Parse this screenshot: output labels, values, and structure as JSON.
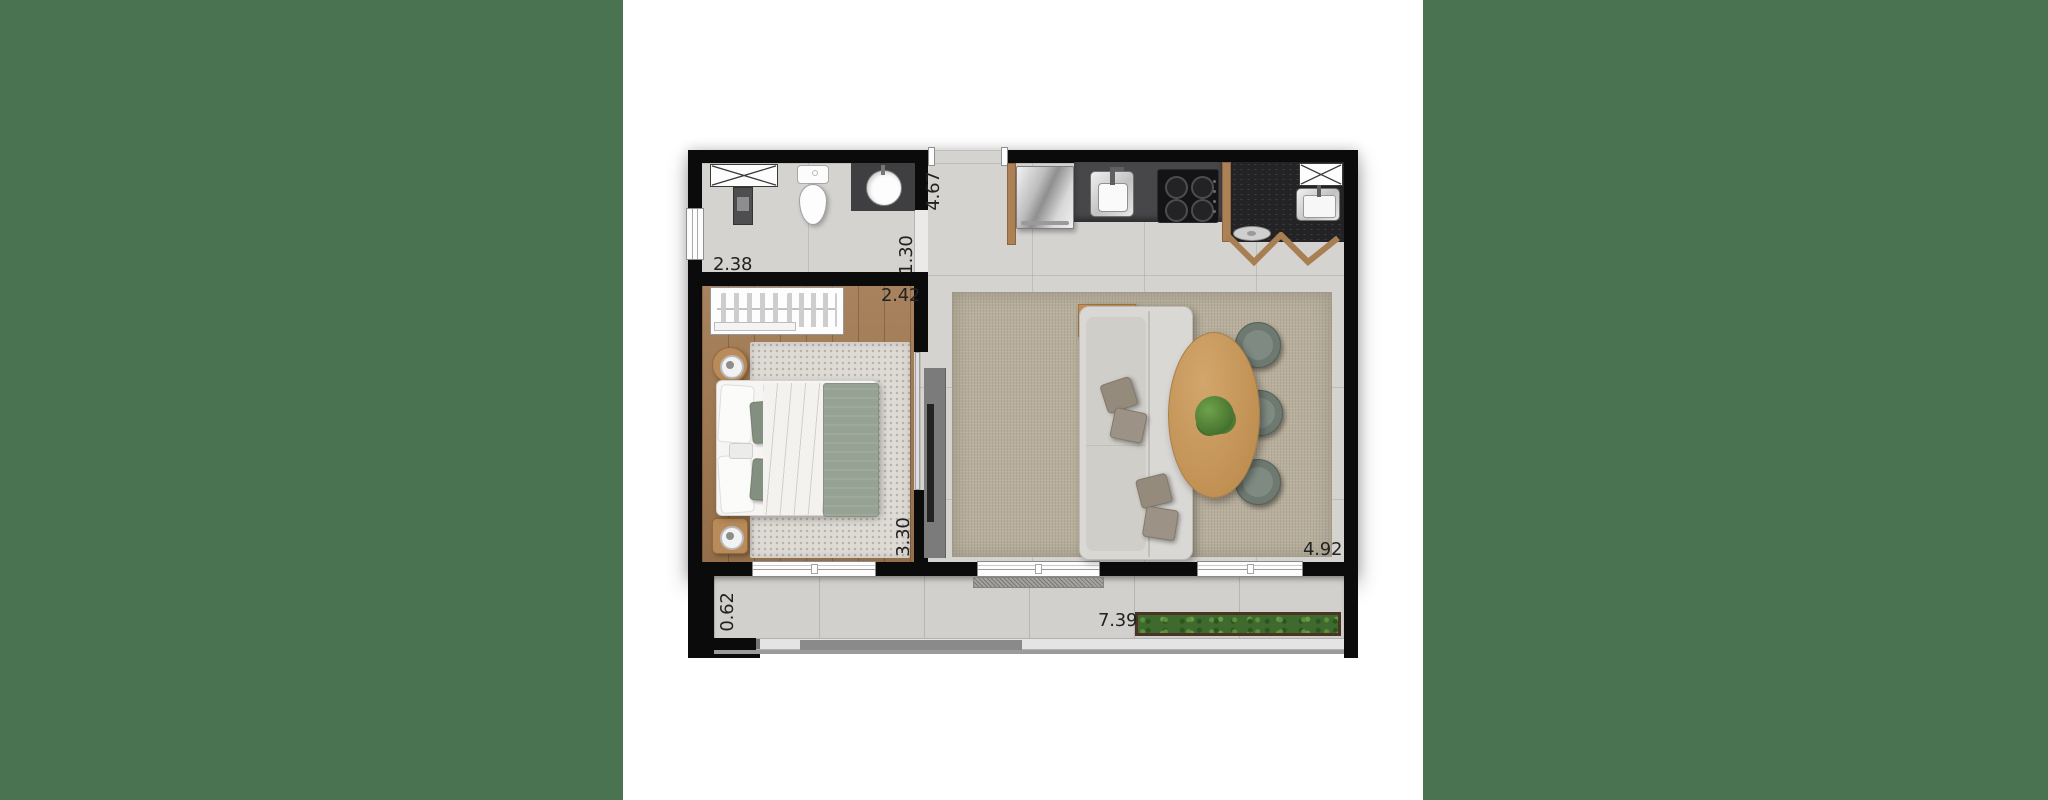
{
  "page": {
    "background": "#ffffff",
    "type": "apartment-floor-plan-render"
  },
  "side_panels": {
    "color": "#497351"
  },
  "floor_plan": {
    "dimension_labels": {
      "bathroom_width": "2.38",
      "hall_depth": "4.67",
      "hall_width": "1.30",
      "bedroom_width": "2.42",
      "bedroom_length": "3.30",
      "living_width": "4.92",
      "balcony_depth": "0.62",
      "balcony_length": "7.39"
    },
    "colors": {
      "wall": "#0b0b0b",
      "floor_tile": "#d5d3d0",
      "bedroom_wood_floor": "#a0784f",
      "living_rug": "#b7ae9b",
      "bedroom_rug": "#dedbd5",
      "kitchen_counter": "#47474a",
      "granite_counter": "#232326",
      "cabinet_wood": "#ad8156",
      "dining_table_wood": "#c7975e",
      "chair_upholstery": "#6e7a71",
      "plant_green": "#4c7a33",
      "bed_blanket": "#96a294",
      "planter_foliage": "#3f6a2e"
    }
  }
}
